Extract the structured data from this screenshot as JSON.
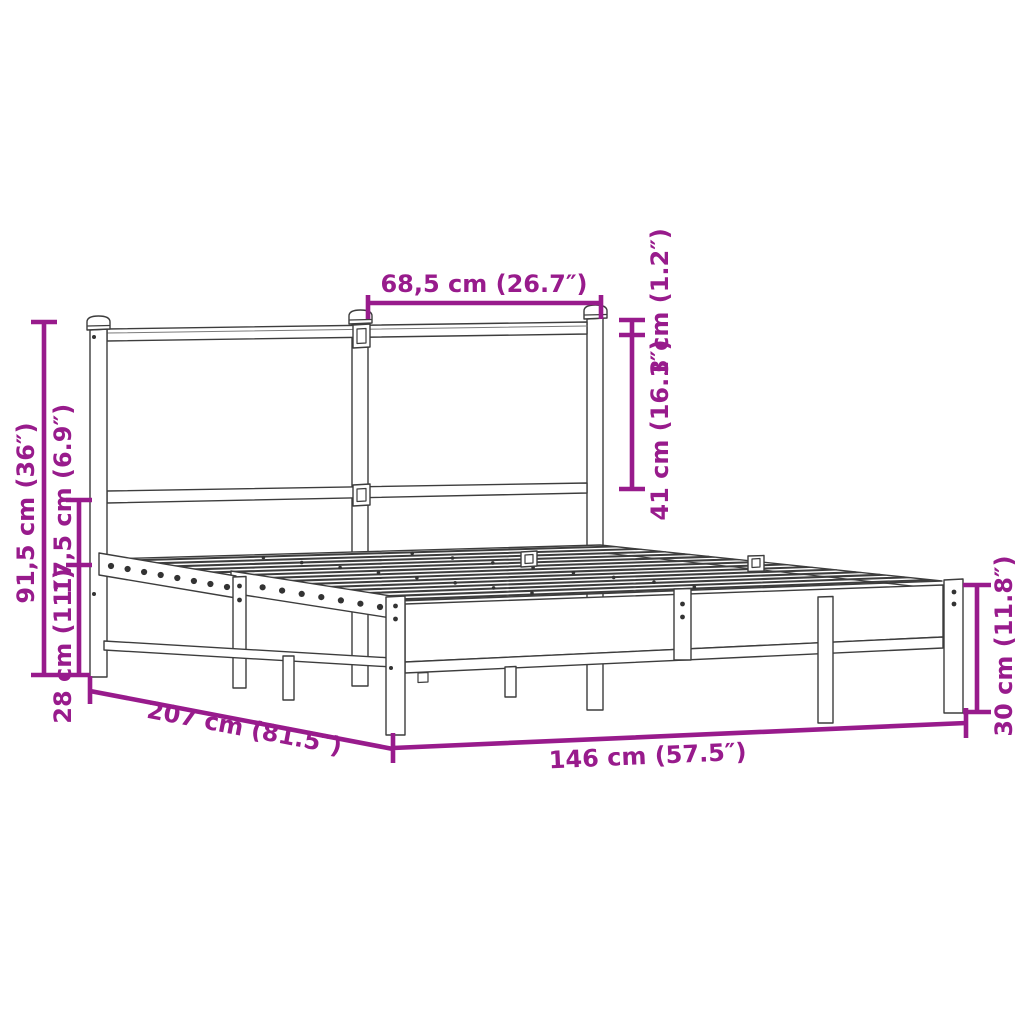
{
  "diagram": {
    "type": "product-dimension-drawing",
    "subject": "metal bed frame with slatted base and headboard",
    "accent_color": "#981b8c",
    "line_color": "#3d3d3d",
    "background_color": "#ffffff"
  },
  "dims": {
    "headboard_section_width": "68,5 cm (26.7″)",
    "top_rail_thickness": "3 cm (1.2″)",
    "headboard_panel_height": "41 cm (16.1″)",
    "headboard_height": "91,5 cm (36″)",
    "deck_to_rail_gap": "17,5 cm (6.9″)",
    "underbed_clearance": "28 cm (11″)",
    "frame_length": "207 cm (81.5″)",
    "frame_width": "146 cm (57.5″)",
    "foot_end_height": "30 cm (11.8″)"
  }
}
